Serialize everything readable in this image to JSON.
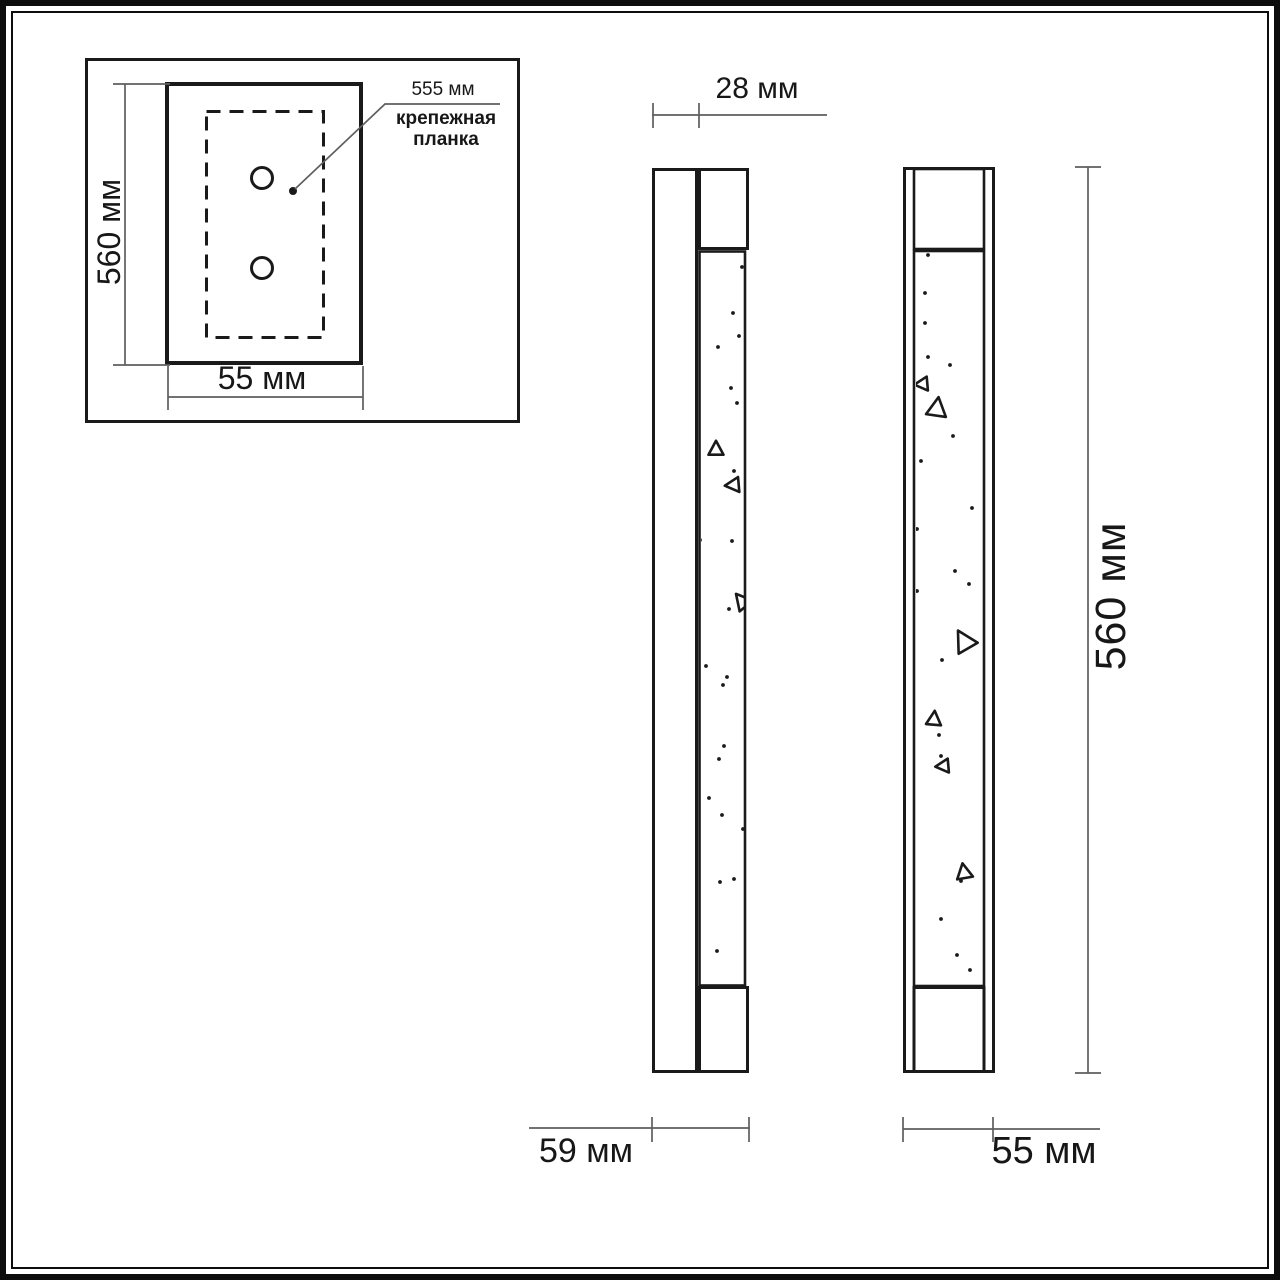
{
  "inset": {
    "height_label": "560 мм",
    "width_label": "55 мм",
    "plate_dim_label": "555 мм",
    "plate_name": "крепежная планка"
  },
  "side_view": {
    "backplate_depth_label": "28 мм",
    "total_depth_label": "59 мм"
  },
  "front_view": {
    "width_label": "55 мм",
    "height_label": "560 мм"
  },
  "colors": {
    "object_line": "#1a1a1a",
    "dimension_line": "#5f5f5f",
    "text": "#171717",
    "background": "#ffffff"
  },
  "decor": {
    "side_view": {
      "dots": [
        [
          742,
          267
        ],
        [
          733,
          313
        ],
        [
          739,
          336
        ],
        [
          718,
          347
        ],
        [
          731,
          388
        ],
        [
          737,
          403
        ],
        [
          734,
          471
        ],
        [
          700,
          540
        ],
        [
          732,
          541
        ],
        [
          729,
          609
        ],
        [
          706,
          666
        ],
        [
          727,
          677
        ],
        [
          723,
          685
        ],
        [
          724,
          746
        ],
        [
          719,
          759
        ],
        [
          709,
          798
        ],
        [
          722,
          815
        ],
        [
          743,
          829
        ],
        [
          734,
          879
        ],
        [
          720,
          882
        ],
        [
          717,
          951
        ]
      ],
      "triangles": [
        {
          "x": 716,
          "y": 449,
          "s": 15,
          "a": 0
        },
        {
          "x": 733,
          "y": 485,
          "s": 15,
          "a": -95
        },
        {
          "x": 742,
          "y": 601,
          "s": 17,
          "a": -40
        }
      ]
    },
    "front_view": {
      "dots": [
        [
          928,
          255
        ],
        [
          925,
          293
        ],
        [
          925,
          323
        ],
        [
          928,
          357
        ],
        [
          950,
          365
        ],
        [
          953,
          436
        ],
        [
          921,
          461
        ],
        [
          972,
          508
        ],
        [
          917,
          529
        ],
        [
          955,
          571
        ],
        [
          969,
          584
        ],
        [
          917,
          591
        ],
        [
          942,
          660
        ],
        [
          939,
          735
        ],
        [
          941,
          756
        ],
        [
          961,
          881
        ],
        [
          941,
          919
        ],
        [
          957,
          955
        ],
        [
          970,
          970
        ]
      ],
      "triangles": [
        {
          "x": 922,
          "y": 384,
          "s": 14,
          "a": -95
        },
        {
          "x": 937,
          "y": 408,
          "s": 20,
          "a": 8
        },
        {
          "x": 964,
          "y": 641,
          "s": 22,
          "a": -30
        },
        {
          "x": 934,
          "y": 719,
          "s": 15,
          "a": 5
        },
        {
          "x": 943,
          "y": 766,
          "s": 14,
          "a": -95
        },
        {
          "x": 964,
          "y": 872,
          "s": 16,
          "a": -10
        }
      ]
    }
  }
}
